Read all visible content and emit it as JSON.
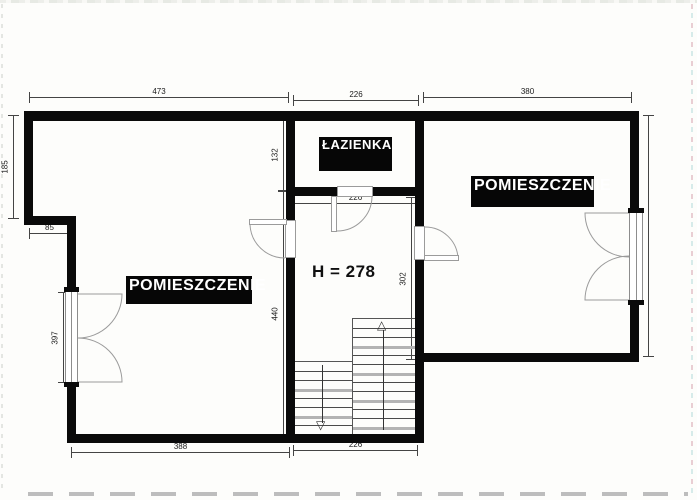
{
  "drawing": {
    "rooms": {
      "left_room_label": "POMIESZCZENIE",
      "bathroom_label": "ŁAZIENKA",
      "right_room_label": "POMIESZCZENIE"
    },
    "ceiling_height_note": "H = 278",
    "dimensions": {
      "top_left_width": "473",
      "top_middle_width": "226",
      "top_right_width": "380",
      "left_upper_height": "185",
      "left_step_width": "85",
      "bathroom_inner_height": "132",
      "bathroom_inner_width": "226",
      "left_window_height": "397",
      "hall_inner_height": "440",
      "hall_right_height": "302",
      "right_side_height": "439",
      "bottom_left_width": "388",
      "bottom_middle_width": "226"
    },
    "icons": {
      "stairs_up_arrow": "△",
      "stairs_down_arrow": "▽"
    }
  }
}
